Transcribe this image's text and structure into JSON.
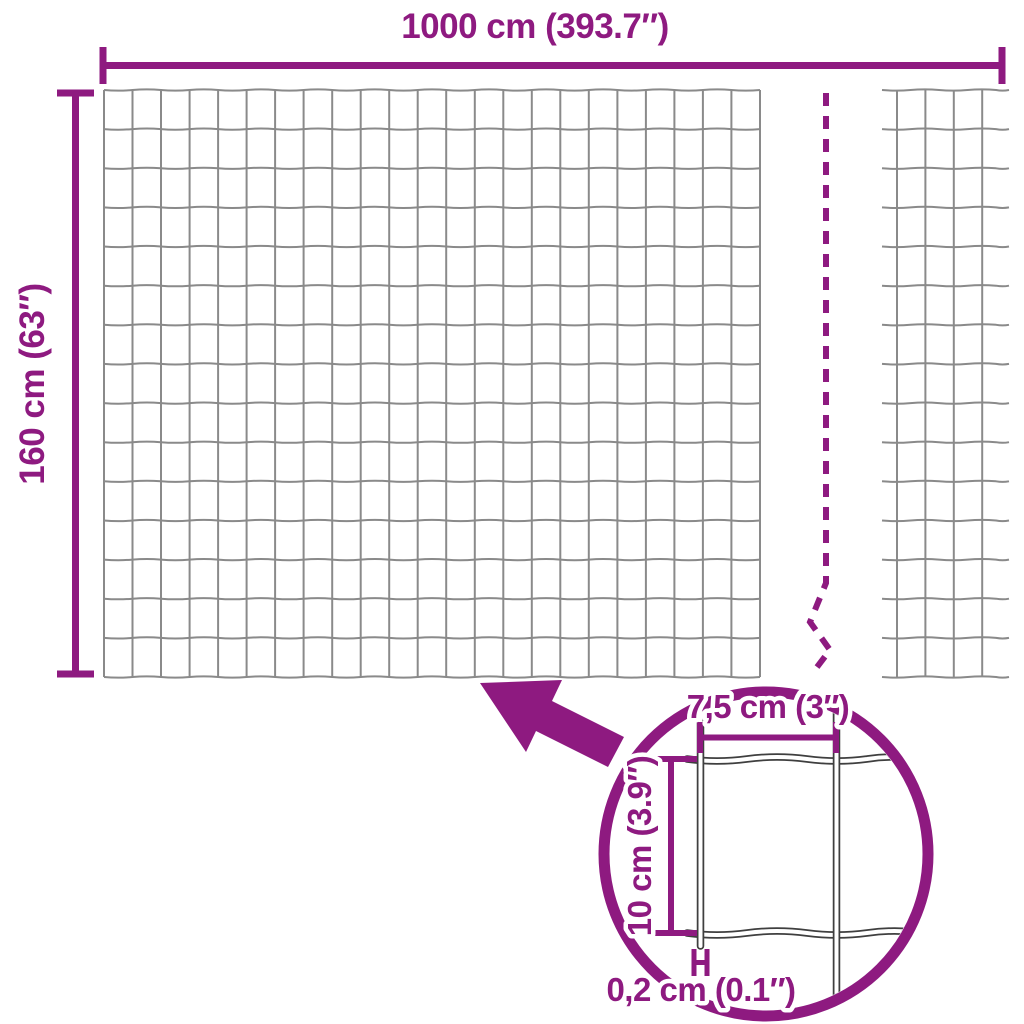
{
  "colors": {
    "accent": "#8E1A80",
    "wire": "#8A8A8A",
    "detail_wire": "#3F3F3F",
    "background": "#FFFFFF"
  },
  "fence": {
    "width_label": "1000 cm (393.7″)",
    "height_label": "160 cm (63″)"
  },
  "detail": {
    "cell_width_label": "7,5 cm (3″)",
    "cell_height_label": "10 cm (3.9″)",
    "wire_thickness_label": "0,2 cm (0.1″)"
  }
}
